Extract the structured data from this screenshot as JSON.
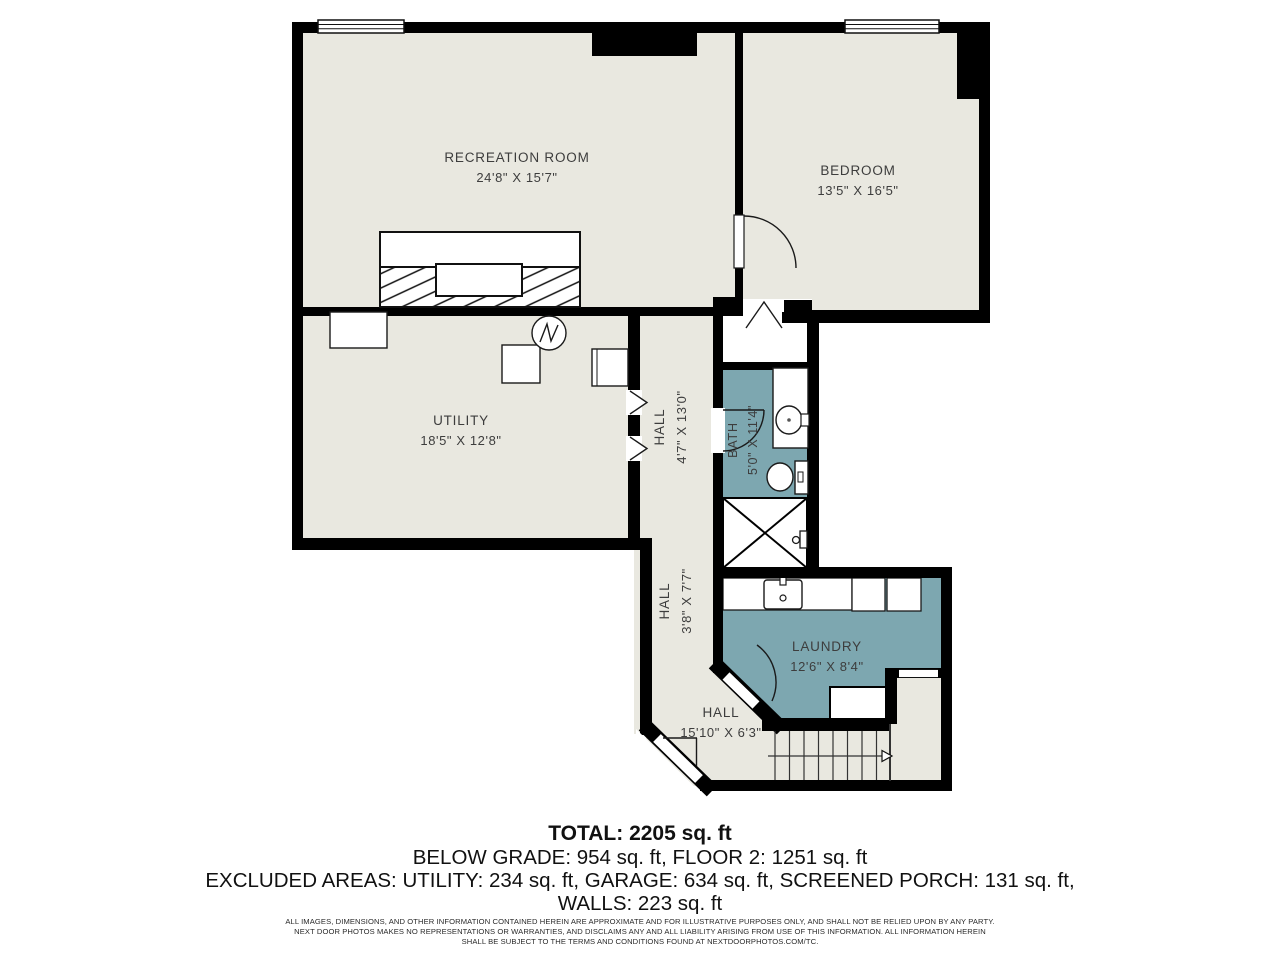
{
  "rooms": {
    "recreation": {
      "name": "RECREATION ROOM",
      "dims": "24'8\" X 15'7\""
    },
    "bedroom": {
      "name": "BEDROOM",
      "dims": "13'5\" X 16'5\""
    },
    "utility": {
      "name": "UTILITY",
      "dims": "18'5\" X 12'8\""
    },
    "hall_upper": {
      "name": "HALL",
      "dims": "4'7\" X 13'0\""
    },
    "bath": {
      "name": "BATH",
      "dims": "5'0\" X 11'4\""
    },
    "hall_mid": {
      "name": "HALL",
      "dims": "3'8\" X 7'7\""
    },
    "laundry": {
      "name": "LAUNDRY",
      "dims": "12'6\" X 8'4\""
    },
    "hall_lower": {
      "name": "HALL",
      "dims": "15'10\" X 6'3\""
    }
  },
  "summary": {
    "total": "TOTAL: 2205 sq. ft",
    "line2": "BELOW GRADE: 954 sq. ft, FLOOR 2: 1251 sq. ft",
    "line3": "EXCLUDED AREAS: UTILITY: 234 sq. ft, GARAGE: 634 sq. ft, SCREENED PORCH: 131 sq. ft,",
    "line4": "WALLS: 223 sq. ft"
  },
  "disclaimer": {
    "line1": "ALL IMAGES, DIMENSIONS, AND OTHER INFORMATION CONTAINED HEREIN ARE APPROXIMATE AND FOR ILLUSTRATIVE PURPOSES ONLY, AND SHALL NOT BE RELIED UPON BY ANY PARTY.",
    "line2": "NEXT DOOR PHOTOS MAKES NO REPRESENTATIONS OR WARRANTIES, AND DISCLAIMS ANY AND ALL LIABILITY ARISING FROM USE OF THIS INFORMATION. ALL INFORMATION HEREIN",
    "line3": "SHALL BE SUBJECT TO THE TERMS AND CONDITIONS FOUND AT NEXTDOORPHOTOS.COM/TC."
  },
  "colors": {
    "floor": "#e9e8e0",
    "wet_room": "#7da7b0",
    "wall": "#000000"
  }
}
